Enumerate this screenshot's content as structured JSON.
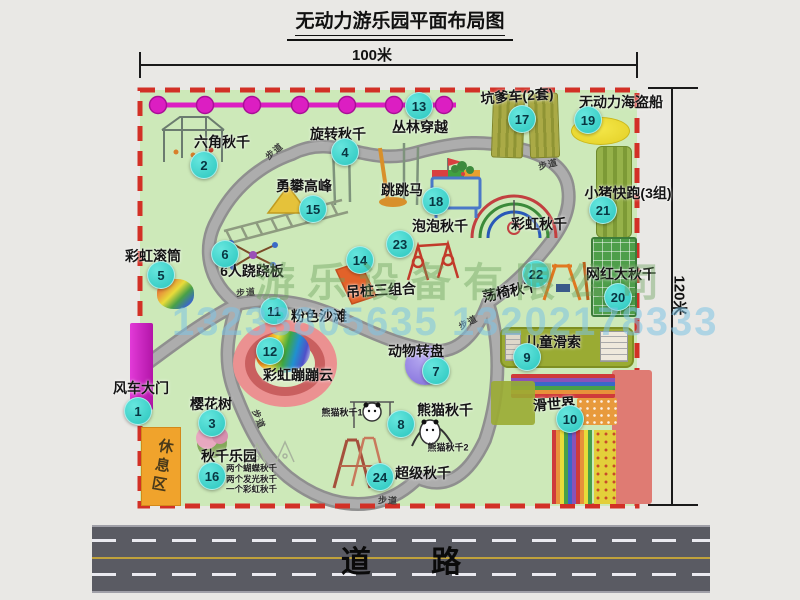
{
  "title": "无动力游乐园平面布局图",
  "dimensions": {
    "width_label": "100米",
    "height_label": "120米"
  },
  "road": {
    "label": "道 路"
  },
  "watermarks": {
    "company": "游乐设备有限公司",
    "phone": "13233805635 13202178333"
  },
  "rest_area_label": "休息区",
  "path_label": "步道",
  "attractions": [
    {
      "num": "1",
      "name": "风车大门"
    },
    {
      "num": "2",
      "name": "六角秋千"
    },
    {
      "num": "3",
      "name": "樱花树"
    },
    {
      "num": "4",
      "name": "旋转秋千"
    },
    {
      "num": "5",
      "name": "彩虹滚筒"
    },
    {
      "num": "6",
      "name": "6人跷跷板"
    },
    {
      "num": "7",
      "name": "动物转盘"
    },
    {
      "num": "8",
      "name": "熊猫秋千",
      "sub1": "熊猫秋千1",
      "sub2": "熊猫秋千2"
    },
    {
      "num": "9",
      "name": "儿童滑索"
    },
    {
      "num": "10",
      "name": "滑世界"
    },
    {
      "num": "11",
      "name": "粉色沙滩"
    },
    {
      "num": "12",
      "name": "彩虹蹦蹦云"
    },
    {
      "num": "13",
      "name": "丛林穿越"
    },
    {
      "num": "14",
      "name": "吊桩三组合"
    },
    {
      "num": "15",
      "name": "勇攀高峰"
    },
    {
      "num": "16",
      "name": "秋千乐园",
      "details": [
        "两个蝴蝶秋千",
        "两个发光秋千",
        "一个彩虹秋千"
      ]
    },
    {
      "num": "17",
      "name": "坑爹车(2套)"
    },
    {
      "num": "18",
      "name": "跳跳马"
    },
    {
      "num": "19",
      "name": "无动力海盗船"
    },
    {
      "num": "20",
      "name": "网红大秋千"
    },
    {
      "num": "21",
      "name": "小猪快跑(3组)"
    },
    {
      "num": "22",
      "name": "荡椅秋千"
    },
    {
      "num": "23",
      "name": "泡泡秋千"
    },
    {
      "num": "24",
      "name": "超级秋千"
    }
  ],
  "unnumbered": [
    {
      "name": "彩虹秋千"
    }
  ],
  "colors": {
    "park": "#cde9b9",
    "border-red": "#d23026",
    "badge": "#2ac6be",
    "road": "#5a5b63",
    "zipline": "#dc1ec2"
  }
}
